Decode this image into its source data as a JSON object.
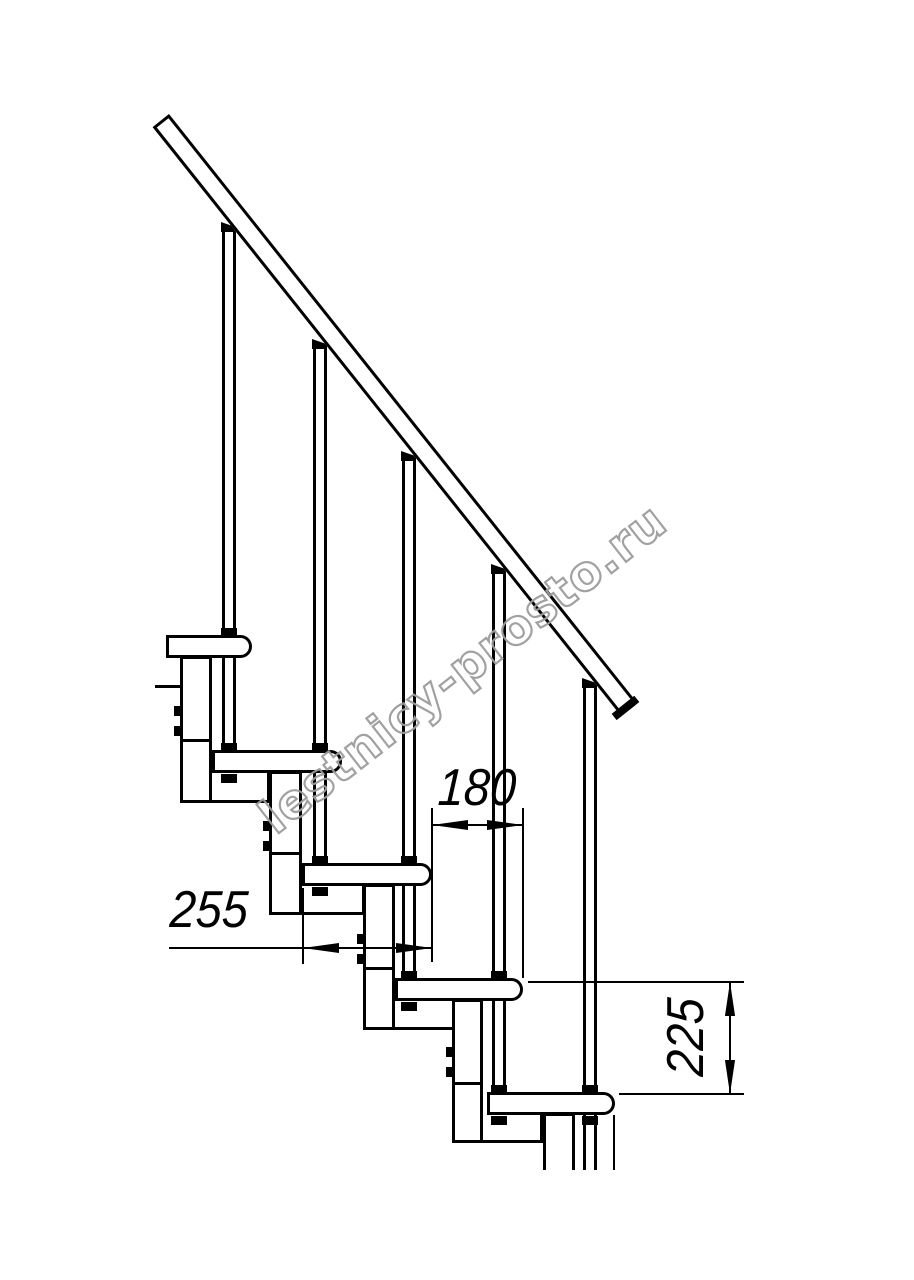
{
  "watermark": {
    "text": "lestnicy-prosto.ru",
    "stroke_color": "#9c9c9c"
  },
  "dimensions": {
    "going": {
      "label": "180",
      "orientation": "horizontal"
    },
    "tread_depth": {
      "label": "255",
      "orientation": "horizontal"
    },
    "rise": {
      "label": "225",
      "orientation": "vertical"
    }
  },
  "colors": {
    "line": "#000000",
    "background": "#ffffff"
  },
  "structure": {
    "treads": 5,
    "balusters": 5,
    "handrail": 1,
    "stringer_modules": 5
  }
}
